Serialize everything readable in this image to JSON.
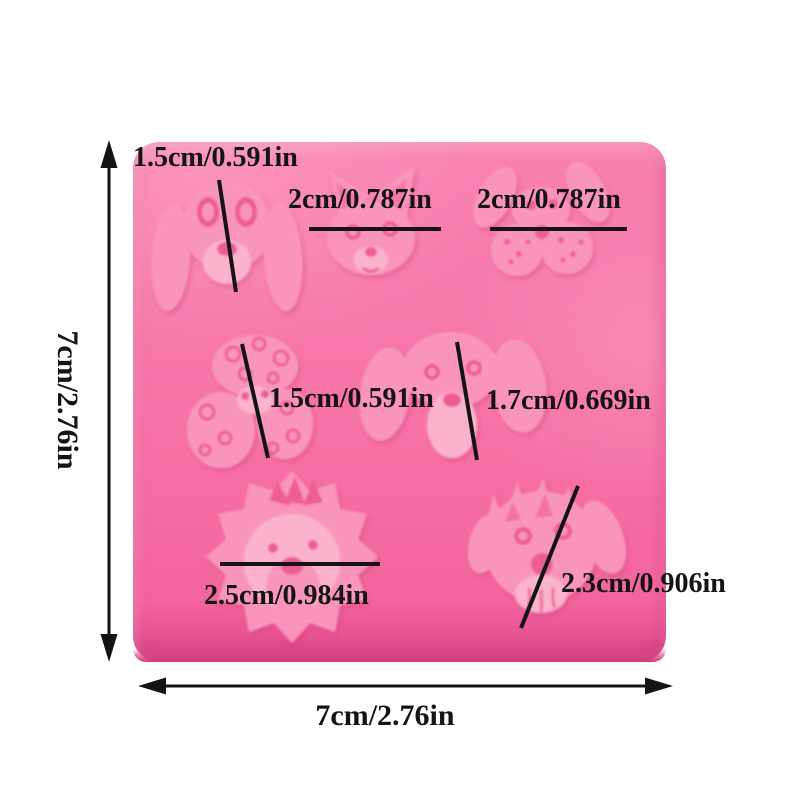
{
  "colors": {
    "page_background": "#ffffff",
    "mold_base": "#f772a6",
    "mold_base_top": "#f980b0",
    "mold_light": "#f995bb",
    "mold_lighter": "#fbb2cc",
    "mold_detail_dark": "#ee5b95",
    "mold_edge_dark": "#d94884",
    "annotation": "#141414"
  },
  "overall": {
    "height_label": "7cm/2.76in",
    "width_label": "7cm/2.76in"
  },
  "cavities": [
    {
      "name": "basset-hound-face",
      "size_label": "1.5cm/0.591in"
    },
    {
      "name": "chihuahua-face",
      "size_label": "2cm/0.787in"
    },
    {
      "name": "spaniel-face",
      "size_label": "2cm/0.787in"
    },
    {
      "name": "poodle-face",
      "size_label": "1.5cm/0.591in"
    },
    {
      "name": "beagle-face",
      "size_label": "1.7cm/0.669in"
    },
    {
      "name": "sheepdog-face",
      "size_label": "2.5cm/0.984in"
    },
    {
      "name": "terrier-face",
      "size_label": "2.3cm/0.906in"
    }
  ]
}
